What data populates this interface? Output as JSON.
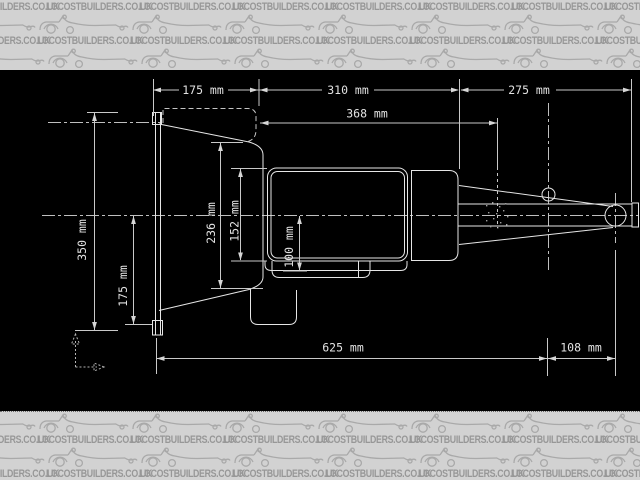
{
  "watermark": {
    "text": "LOCOSTBUILDERS.CO.UK"
  },
  "canvas": {
    "background": "#000000",
    "band_color": "#d2d2d2",
    "watermark_text_color": "#979797",
    "line_color": "#e6e6e6"
  },
  "drawing": {
    "type": "technical-drawing",
    "subject": "gearbox side elevation with bellhousing, main case, sump and tail shaft",
    "units": "mm"
  },
  "dimensions": [
    {
      "id": "bellhousing-length-top",
      "label": "175 mm",
      "value": 175,
      "unit": "mm",
      "orientation": "horizontal"
    },
    {
      "id": "main-case-length",
      "label": "310 mm",
      "value": 310,
      "unit": "mm",
      "orientation": "horizontal"
    },
    {
      "id": "tail-length",
      "label": "275 mm",
      "value": 275,
      "unit": "mm",
      "orientation": "horizontal"
    },
    {
      "id": "case-overall-length",
      "label": "368 mm",
      "value": 368,
      "unit": "mm",
      "orientation": "horizontal"
    },
    {
      "id": "flange-overall-height",
      "label": "350 mm",
      "value": 350,
      "unit": "mm",
      "orientation": "vertical"
    },
    {
      "id": "flange-below-centerline",
      "label": "175 mm",
      "value": 175,
      "unit": "mm",
      "orientation": "vertical"
    },
    {
      "id": "bellhousing-rear-height",
      "label": "236 mm",
      "value": 236,
      "unit": "mm",
      "orientation": "vertical"
    },
    {
      "id": "main-case-height",
      "label": "152 mm",
      "value": 152,
      "unit": "mm",
      "orientation": "vertical"
    },
    {
      "id": "sump-below-centerline",
      "label": "100 mm",
      "value": 100,
      "unit": "mm",
      "orientation": "vertical"
    },
    {
      "id": "overall-length",
      "label": "625 mm",
      "value": 625,
      "unit": "mm",
      "orientation": "horizontal"
    },
    {
      "id": "mount-to-output",
      "label": "108 mm",
      "value": 108,
      "unit": "mm",
      "orientation": "horizontal"
    }
  ]
}
